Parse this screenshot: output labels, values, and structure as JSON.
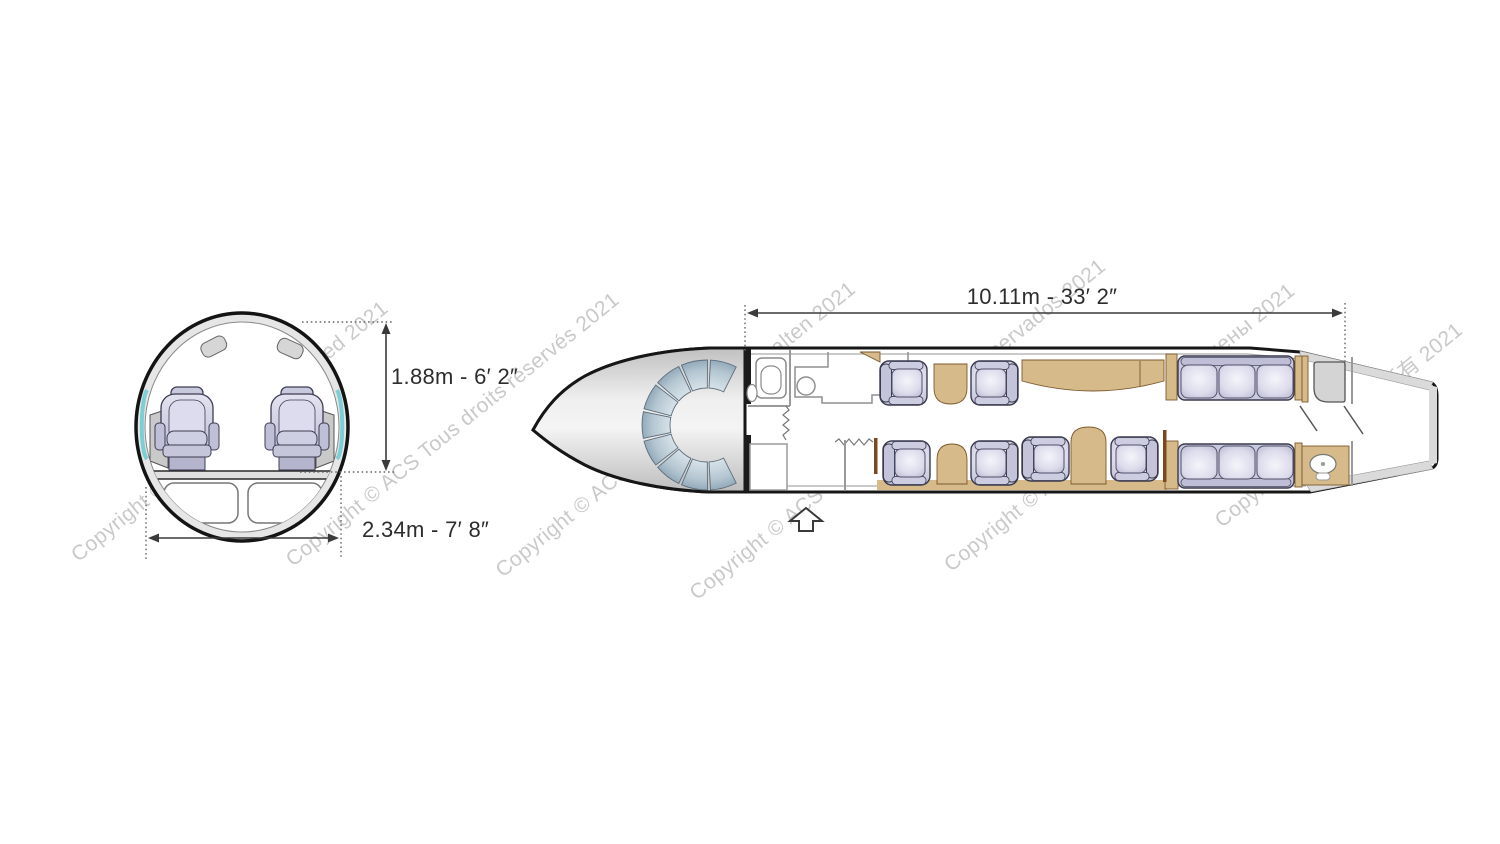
{
  "image": {
    "type": "aircraft cabin layout diagram",
    "background": "#ffffff"
  },
  "cross_section": {
    "label": "fuselage cross-section",
    "cabin_height_label": "1.88m - 6′ 2″",
    "cabin_width_label": "2.34m - 7′ 8″",
    "seat_count": 2
  },
  "floor_plan": {
    "label": "cabin floor plan",
    "cabin_length_label": "10.11m - 33′ 2″",
    "club_chair_count": 6,
    "divan_seat_count": 6
  },
  "watermarks": [
    {
      "text": "Copyright © ACS All rights reserved 2021"
    },
    {
      "text": "Copyright © ACS Tous droits réservés 2021"
    },
    {
      "text": "Copyright © ACS alle Rechte vorbehalten 2021"
    },
    {
      "text": "Copyright © ACS Todos los derechos reservados 2021"
    },
    {
      "text": "Copyright © ACS Все права защищены 2021"
    },
    {
      "text": "Copyright © ACS 版权所有 2021"
    }
  ],
  "colors": {
    "outline": "#1c1c1c",
    "dimension_text": "#2d2d2d",
    "watermark": "#c7c7c7",
    "cabinet_tan": "#d6ba8a",
    "seat_lavender": "#d9d9ea",
    "windshield_blue": "#9db3c4",
    "window_accent": "#7ccfd4",
    "wall_gray": "#dadada"
  }
}
